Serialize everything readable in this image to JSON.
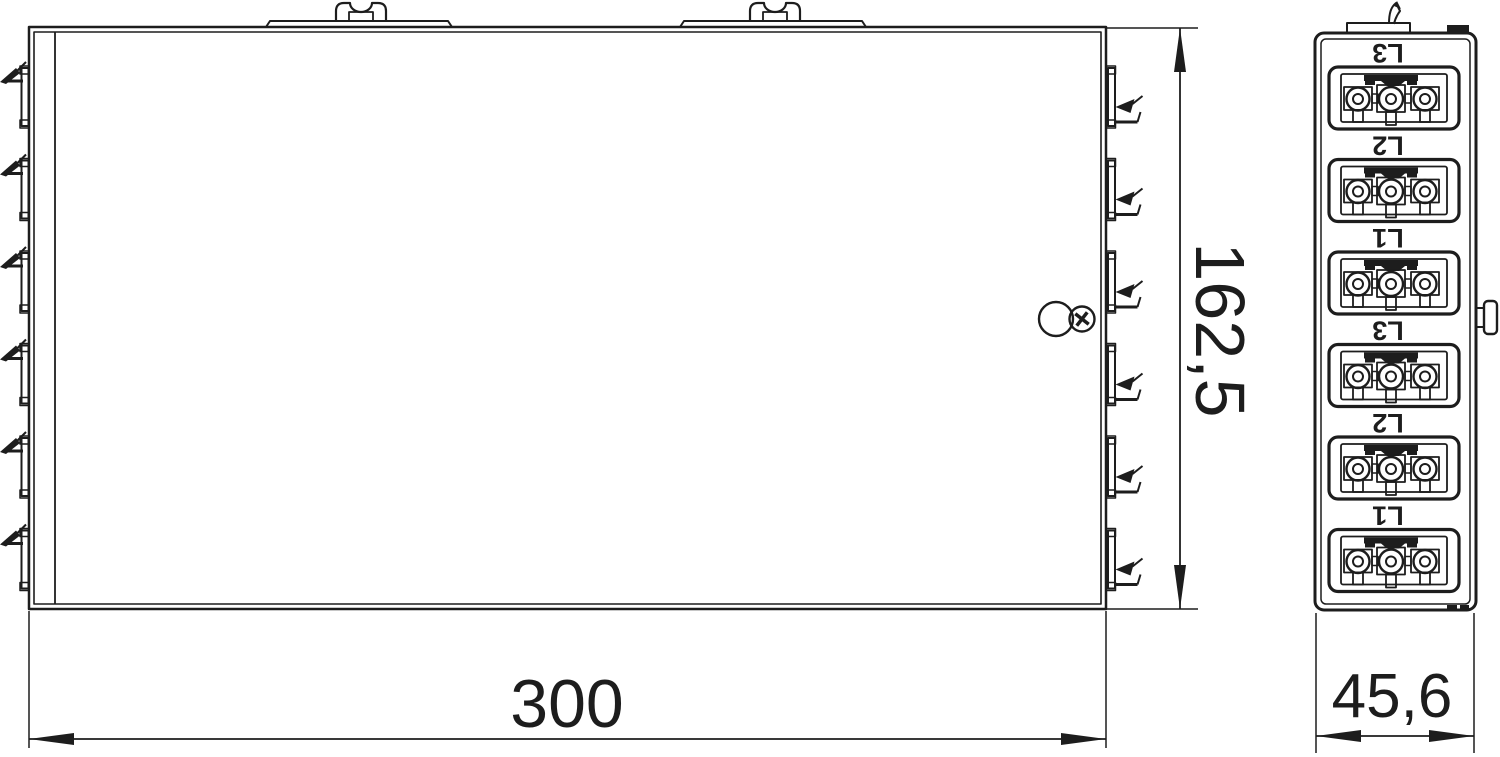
{
  "drawing": {
    "background": "#ffffff",
    "line_color": "#1d1d1d",
    "dimensions": {
      "width": "300",
      "height": "162,5",
      "depth": "45,6"
    },
    "side_view": {
      "phase_labels": [
        "L3",
        "L2",
        "L1",
        "L3",
        "L2",
        "L1"
      ]
    }
  }
}
